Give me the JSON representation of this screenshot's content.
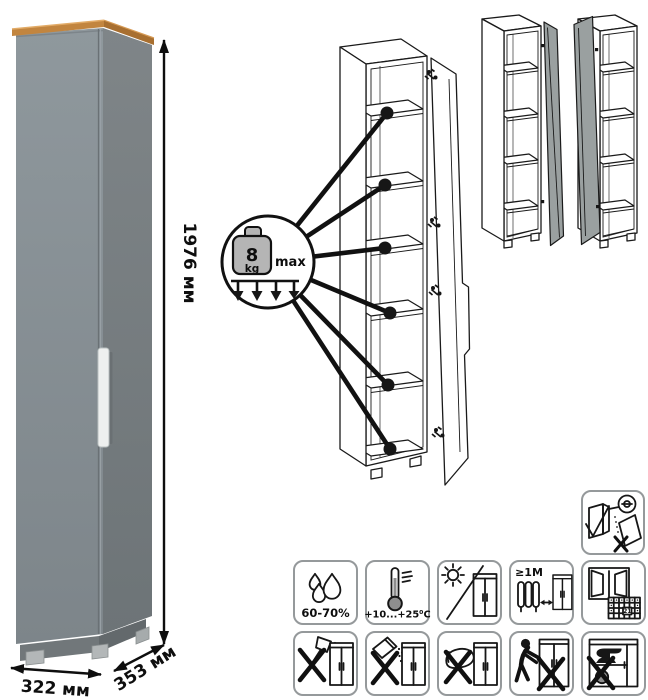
{
  "product": {
    "name": "tall-narrow-cabinet",
    "dimensions": {
      "height": "1976 мм",
      "width": "322 мм",
      "depth": "353 мм"
    }
  },
  "weight_limit_callout": {
    "value": "8",
    "unit": "kg",
    "max_label": "max"
  },
  "care_labels": {
    "humidity": "60-70%",
    "temperature": "+10...+25⁰С",
    "min_distance": "≥1М",
    "calendar_day": "21"
  },
  "icon_names": {
    "row1": [
      "humidity-icon",
      "temperature-icon",
      "no-direct-sunlight-icon",
      "heat-distance-icon",
      "ventilation-calendar-icon"
    ],
    "row2": [
      "no-sharp-tools-icon",
      "no-abrasive-powder-icon",
      "no-wet-sponge-icon",
      "no-dragging-icon",
      "no-heavy-load-icon"
    ],
    "standalone": [
      "anchor-to-wall-icon",
      "shelf-load-callout-icon",
      "door-variant-right-icon",
      "door-variant-left-icon"
    ]
  },
  "colors": {
    "cabinet_front": "#8f989d",
    "cabinet_side": "#7d8488",
    "wood_top": "#c2853f",
    "handle": "#eef0ef",
    "variant_door": "#9aa0a0",
    "line_art": "#1a1a1a"
  }
}
